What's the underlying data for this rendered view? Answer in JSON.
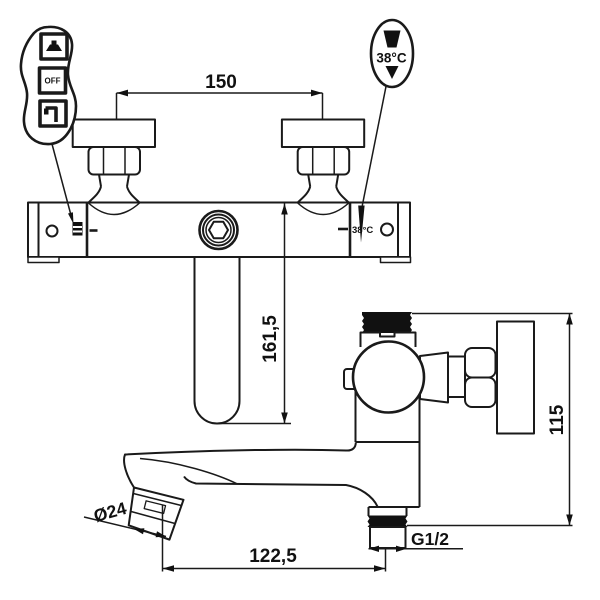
{
  "drawing": {
    "type": "technical-line-drawing",
    "subject": "wall-mounted thermostatic bath mixer tap, front view and side view with dimensions",
    "background_color": "#ffffff",
    "line_color": "#1a1a1a"
  },
  "dimensions": {
    "mount_spacing": "150",
    "spout_drop": "161,5",
    "reach": "122,5",
    "height": "115",
    "thread": "G1/2",
    "aerator": "Ø24"
  },
  "callouts": {
    "temp": "38°C",
    "body_temp": "38°C",
    "off": "OFF"
  },
  "icons": {
    "mode_callout": [
      "shower-icon",
      "off-icon",
      "tap-icon"
    ],
    "temperature_callout": "down-arrow-icon"
  }
}
